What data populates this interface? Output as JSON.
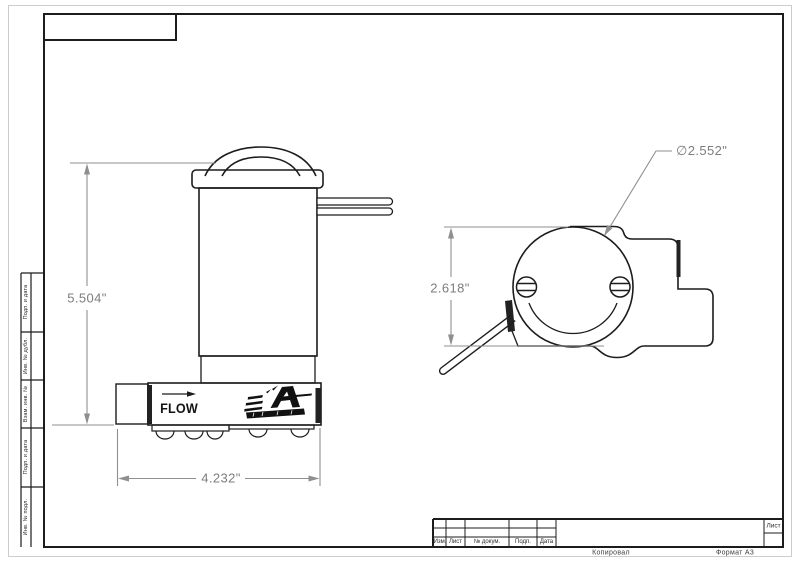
{
  "drawing": {
    "side_view": {
      "flow_label": "FLOW",
      "logo_icon": "aeromotive-logo",
      "height_dim": "5.504\"",
      "width_dim": "4.232\""
    },
    "top_view": {
      "height_dim": "2.618\"",
      "diameter_dim": "∅2.552\""
    }
  },
  "frame": {
    "side_column_labels": [
      "Подп. и дата",
      "Инв. № дубл.",
      "Взам. инв. №",
      "Подп. и дата",
      "Инв. № подл."
    ],
    "title_block": {
      "revision_labels": [
        "Изм.",
        "Лист",
        "№ докум.",
        "Подп.",
        "Дата"
      ],
      "sheet_label": "Лист",
      "footer_copy": "Копировал",
      "footer_format": "Формат А3"
    }
  }
}
